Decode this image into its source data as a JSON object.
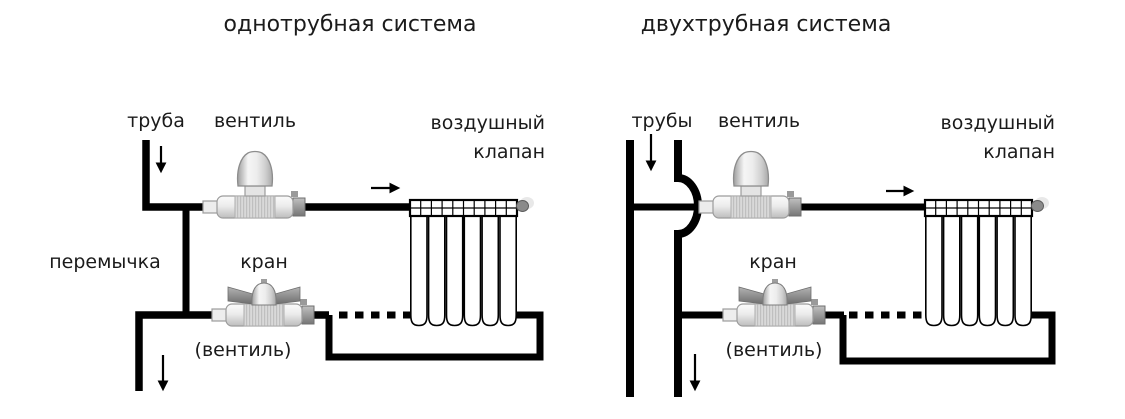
{
  "colors": {
    "line": "#000000",
    "text": "#1b1b1b",
    "valve_light": "#ececec",
    "valve_dark": "#8a8a8a",
    "background": "#ffffff"
  },
  "left": {
    "title": "однотрубная система",
    "labels": {
      "pipe": "труба",
      "valve": "вентиль",
      "air_valve": "воздушный клапан",
      "bypass": "перемычка",
      "tap": "кран",
      "tap_note": "(вентиль)"
    }
  },
  "right": {
    "title": "двухтрубная система",
    "labels": {
      "pipes": "трубы",
      "valve": "вентиль",
      "air_valve": "воздушный клапан",
      "tap": "кран",
      "tap_note": "(вентиль)"
    }
  }
}
